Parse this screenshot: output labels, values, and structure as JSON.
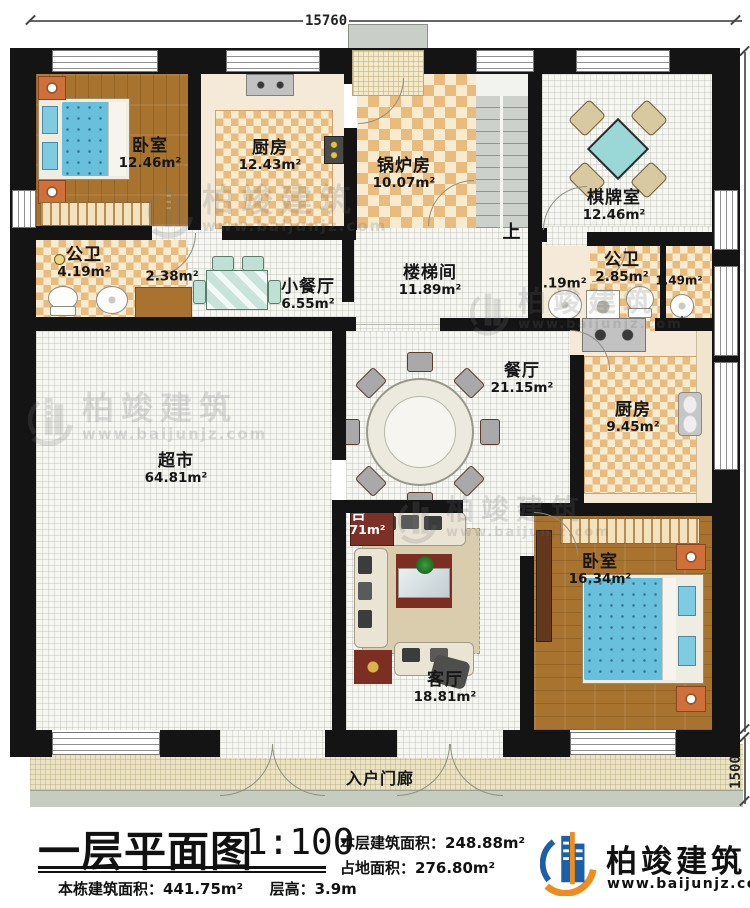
{
  "plan": {
    "dimensions": {
      "top": "15760",
      "side": "15200",
      "porch": "1500"
    },
    "stairs_up": "上",
    "rooms": {
      "bedroom_tl": {
        "name": "卧室",
        "area": "12.46m²"
      },
      "kitchen_top": {
        "name": "厨房",
        "area": "12.43m²"
      },
      "boiler": {
        "name": "锅炉房",
        "area": "10.07m²"
      },
      "chess": {
        "name": "棋牌室",
        "area": "12.46m²"
      },
      "bath_left": {
        "name": "公卫",
        "area": "4.19m²"
      },
      "closet": {
        "area": "2.38m²"
      },
      "small_dining": {
        "name": "小餐厅",
        "area": "6.55m²"
      },
      "stairwell": {
        "name": "楼梯间",
        "area": "11.89m²"
      },
      "lavatory": {
        "area": "2.19m²"
      },
      "bath_right": {
        "name": "公卫",
        "area": "2.85m²"
      },
      "bath_right_inner": {
        "area": "1.49m²"
      },
      "dining": {
        "name": "餐厅",
        "area": "21.15m²"
      },
      "kitchen_right": {
        "name": "厨房",
        "area": "9.45m²"
      },
      "supermarket": {
        "name": "超市",
        "area": "64.81m²"
      },
      "living": {
        "name": "客厅",
        "area": "18.81m²"
      },
      "balcony": {
        "name": "阳台",
        "area": "3.71m²"
      },
      "bedroom_br": {
        "name": "卧室",
        "area": "16.34m²"
      },
      "porch": {
        "name": "入户门廊"
      }
    },
    "watermark": {
      "brand": "柏竣建筑",
      "url": "www.baijunjz.com"
    }
  },
  "titleblock": {
    "title": "一层平面图",
    "scale": "1:100",
    "floor_area_label": "本层建筑面积：",
    "floor_area_value": "248.88m²",
    "site_area_label": "占地面积：",
    "site_area_value": "276.80m²",
    "building_area_label": "本栋建筑面积：",
    "building_area_value": "441.75m²",
    "storey_height_label": "层高：",
    "storey_height_value": "3.9m",
    "brand": "柏竣建筑",
    "brand_url": "www.baijunjz.com"
  },
  "colors": {
    "wall": "#141414",
    "brand_blue": "#1b5fa8",
    "accent_orange": "#f08c1e"
  }
}
